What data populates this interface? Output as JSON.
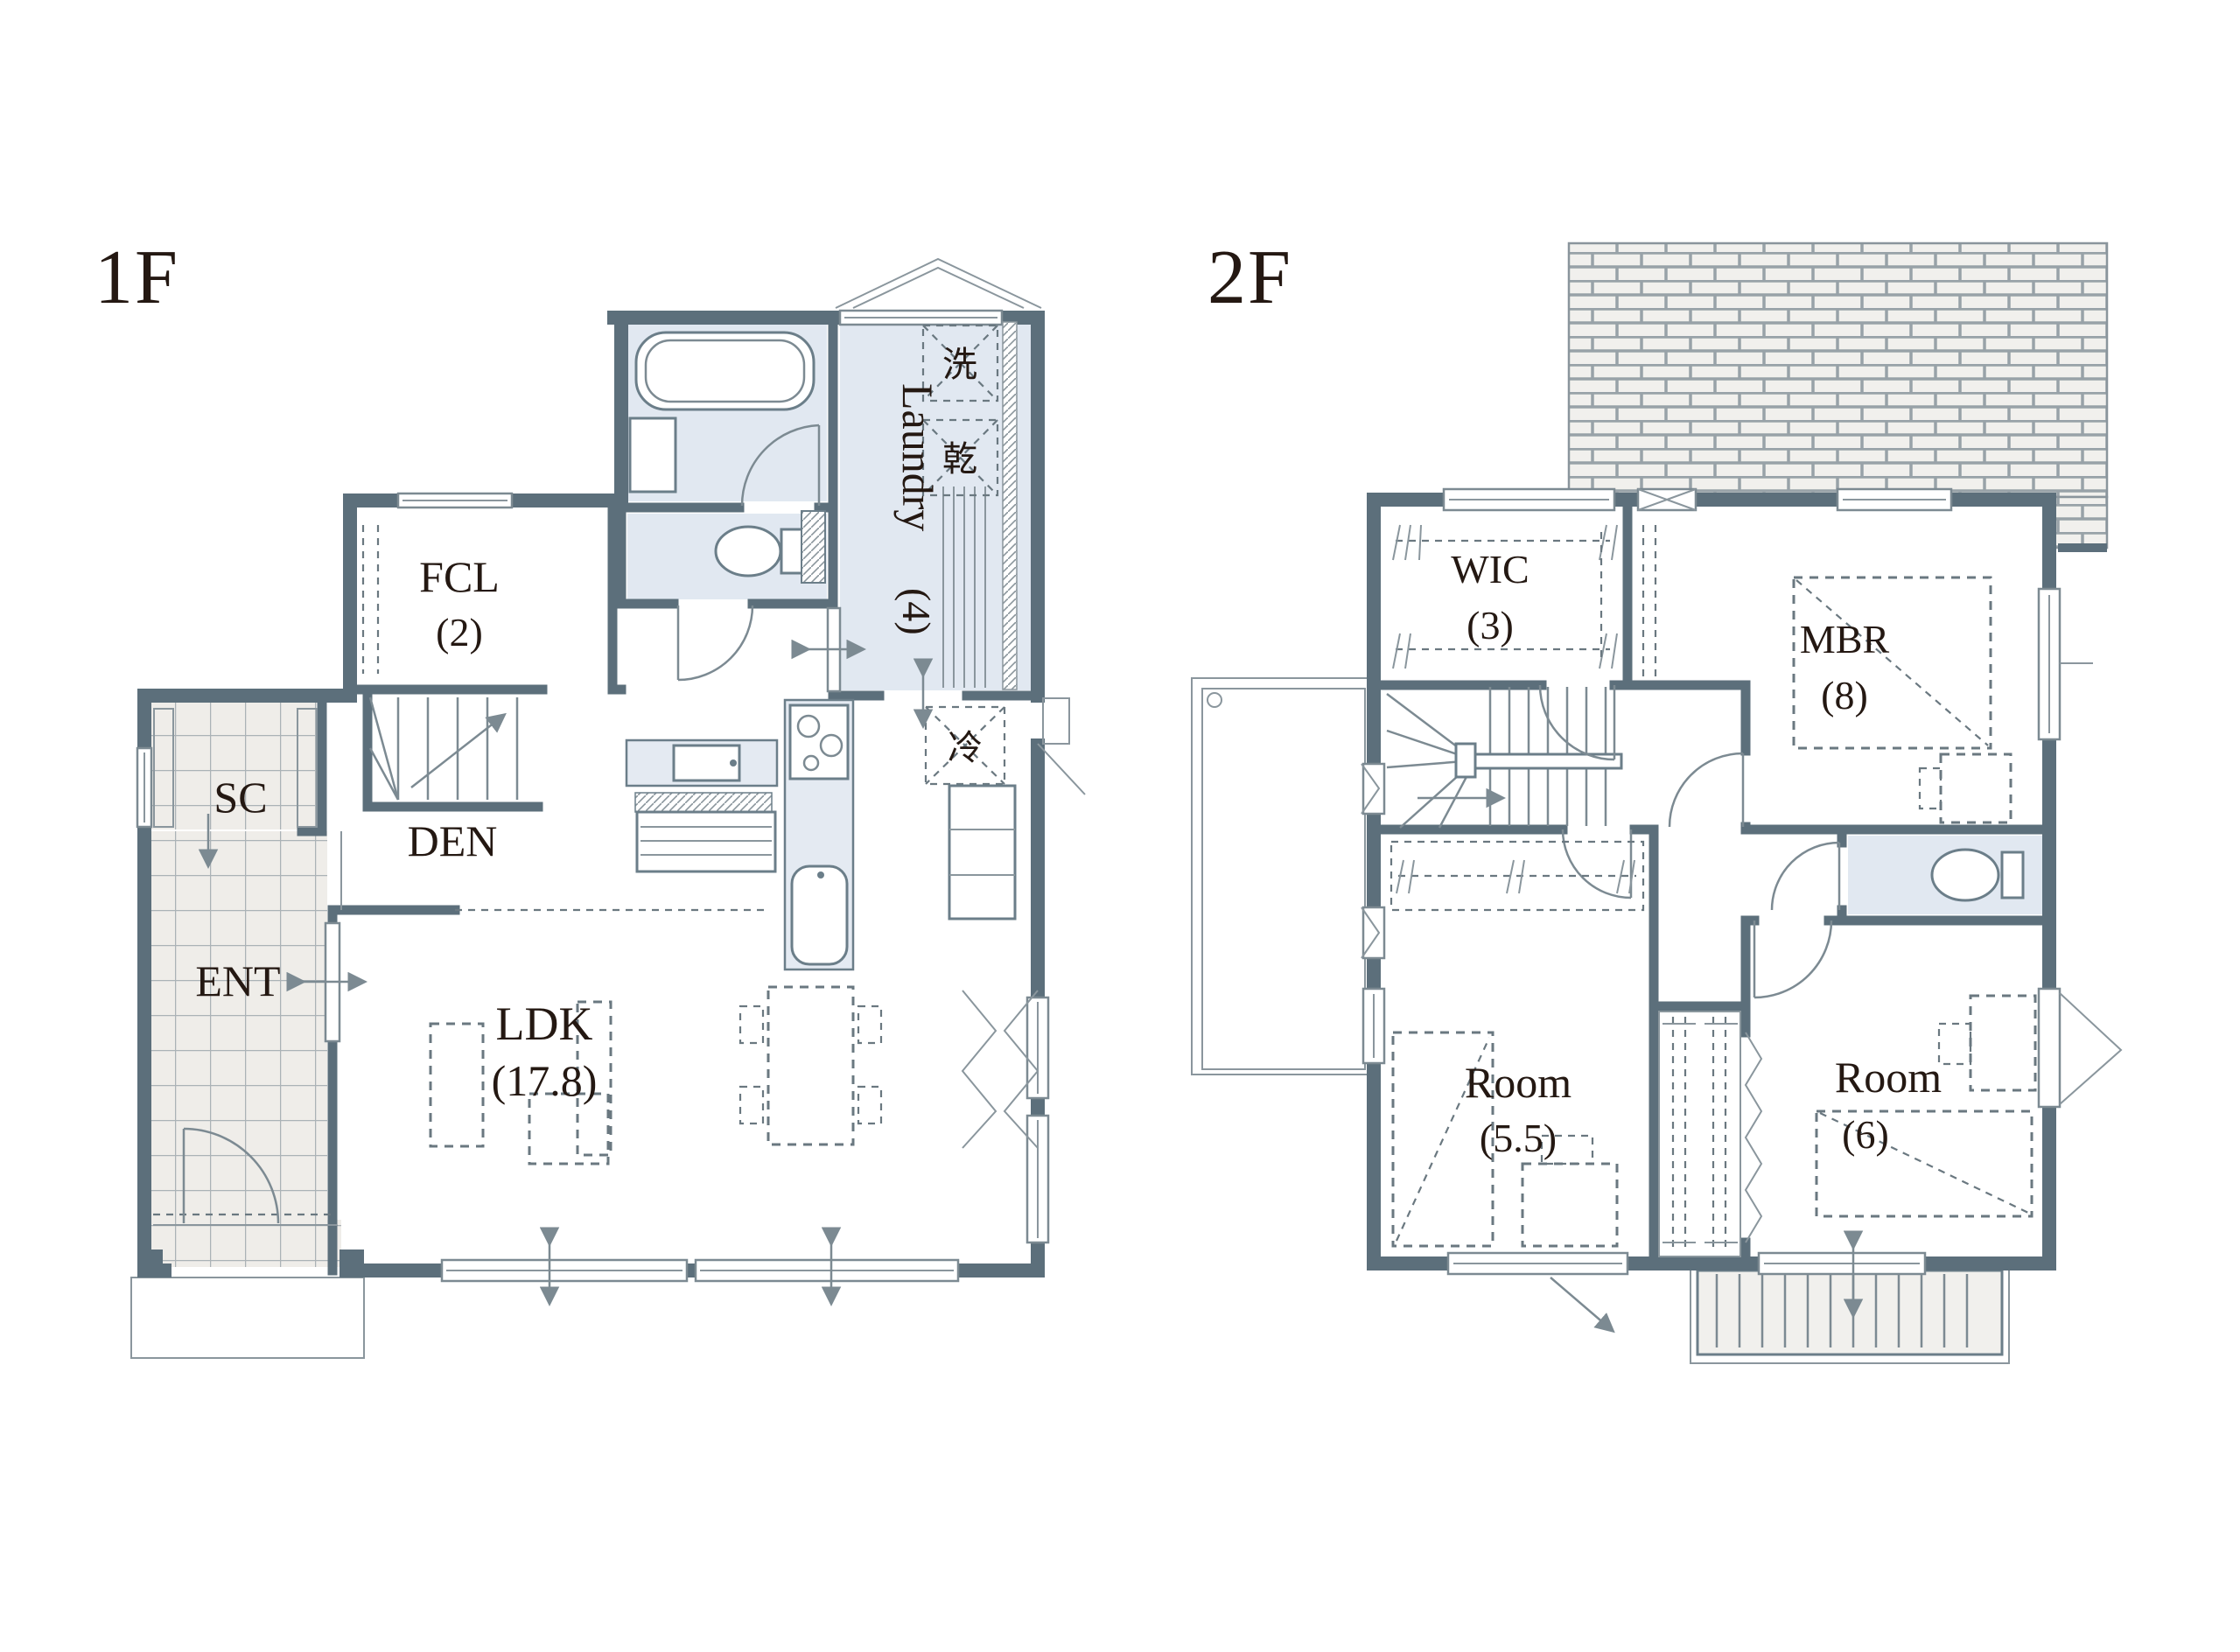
{
  "document": {
    "type": "floor-plan",
    "units": "jo"
  },
  "colors": {
    "wall": "#5C6F7B",
    "wet_area": "#E1E8F1",
    "tile_floor": "#EFEDE9",
    "label_text": "#241812",
    "line": "#7C8A92"
  },
  "floor1": {
    "label": "1F",
    "rooms": {
      "fcl": {
        "name": "FCL",
        "size": "(2)"
      },
      "sc": {
        "name": "SC"
      },
      "den": {
        "name": "DEN"
      },
      "ent": {
        "name": "ENT"
      },
      "ldk": {
        "name": "LDK",
        "size": "(17.8)"
      },
      "laundry": {
        "name": "Laundry",
        "size": "(4)"
      },
      "washer": {
        "symbol": "洗"
      },
      "dryer": {
        "symbol": "乾"
      },
      "fridge": {
        "symbol": "冷"
      }
    }
  },
  "floor2": {
    "label": "2F",
    "rooms": {
      "wic": {
        "name": "WIC",
        "size": "(3)"
      },
      "mbr": {
        "name": "MBR",
        "size": "(8)"
      },
      "room_a": {
        "name": "Room",
        "size": "(5.5)"
      },
      "room_b": {
        "name": "Room",
        "size": "(6)"
      }
    }
  }
}
